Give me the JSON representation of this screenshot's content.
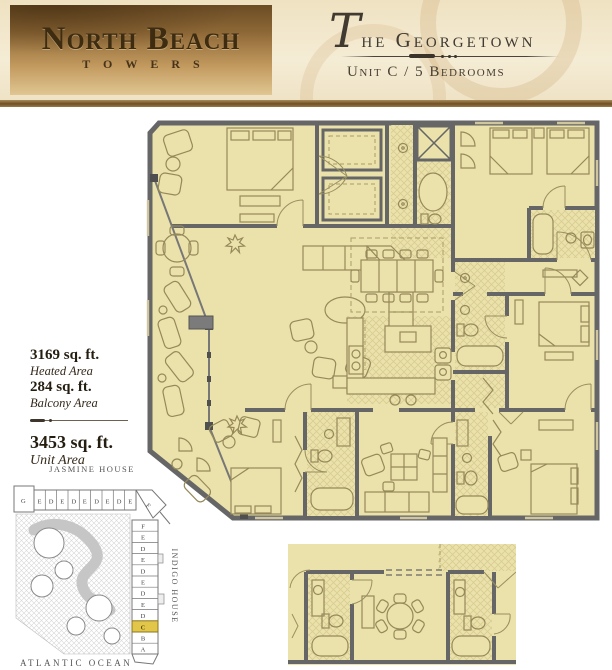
{
  "header": {
    "logo_title": "North Beach",
    "logo_subtitle": "TOWERS",
    "unit_title_initial": "T",
    "unit_title_rest": "he Georgetown",
    "unit_subtitle": "Unit C / 5 Bedrooms"
  },
  "area_stats": {
    "heated_value": "3169 sq. ft.",
    "heated_label": "Heated Area",
    "balcony_value": "284 sq. ft.",
    "balcony_label": "Balcony Area",
    "total_value": "3453 sq. ft.",
    "total_label": "Unit Area"
  },
  "site_map": {
    "jasmine_label": "JASMINE HOUSE",
    "indigo_label": "INDIGO HOUSE",
    "ocean_label": "ATLANTIC OCEAN",
    "highlighted_unit": "C",
    "jasmine_units": [
      "G",
      "E",
      "D",
      "E",
      "D",
      "E",
      "D",
      "E",
      "D",
      "E",
      "F"
    ],
    "indigo_units": [
      "F",
      "E",
      "D",
      "E",
      "D",
      "E",
      "D",
      "E",
      "D",
      "C",
      "B",
      "A"
    ]
  },
  "colors": {
    "floor": "#EBE2AB",
    "walls": "#666666",
    "furniture": "#95895A",
    "site_highlight": "#E2C649",
    "header_brown": "#6E5026",
    "parchment": "#F2E7CB"
  }
}
